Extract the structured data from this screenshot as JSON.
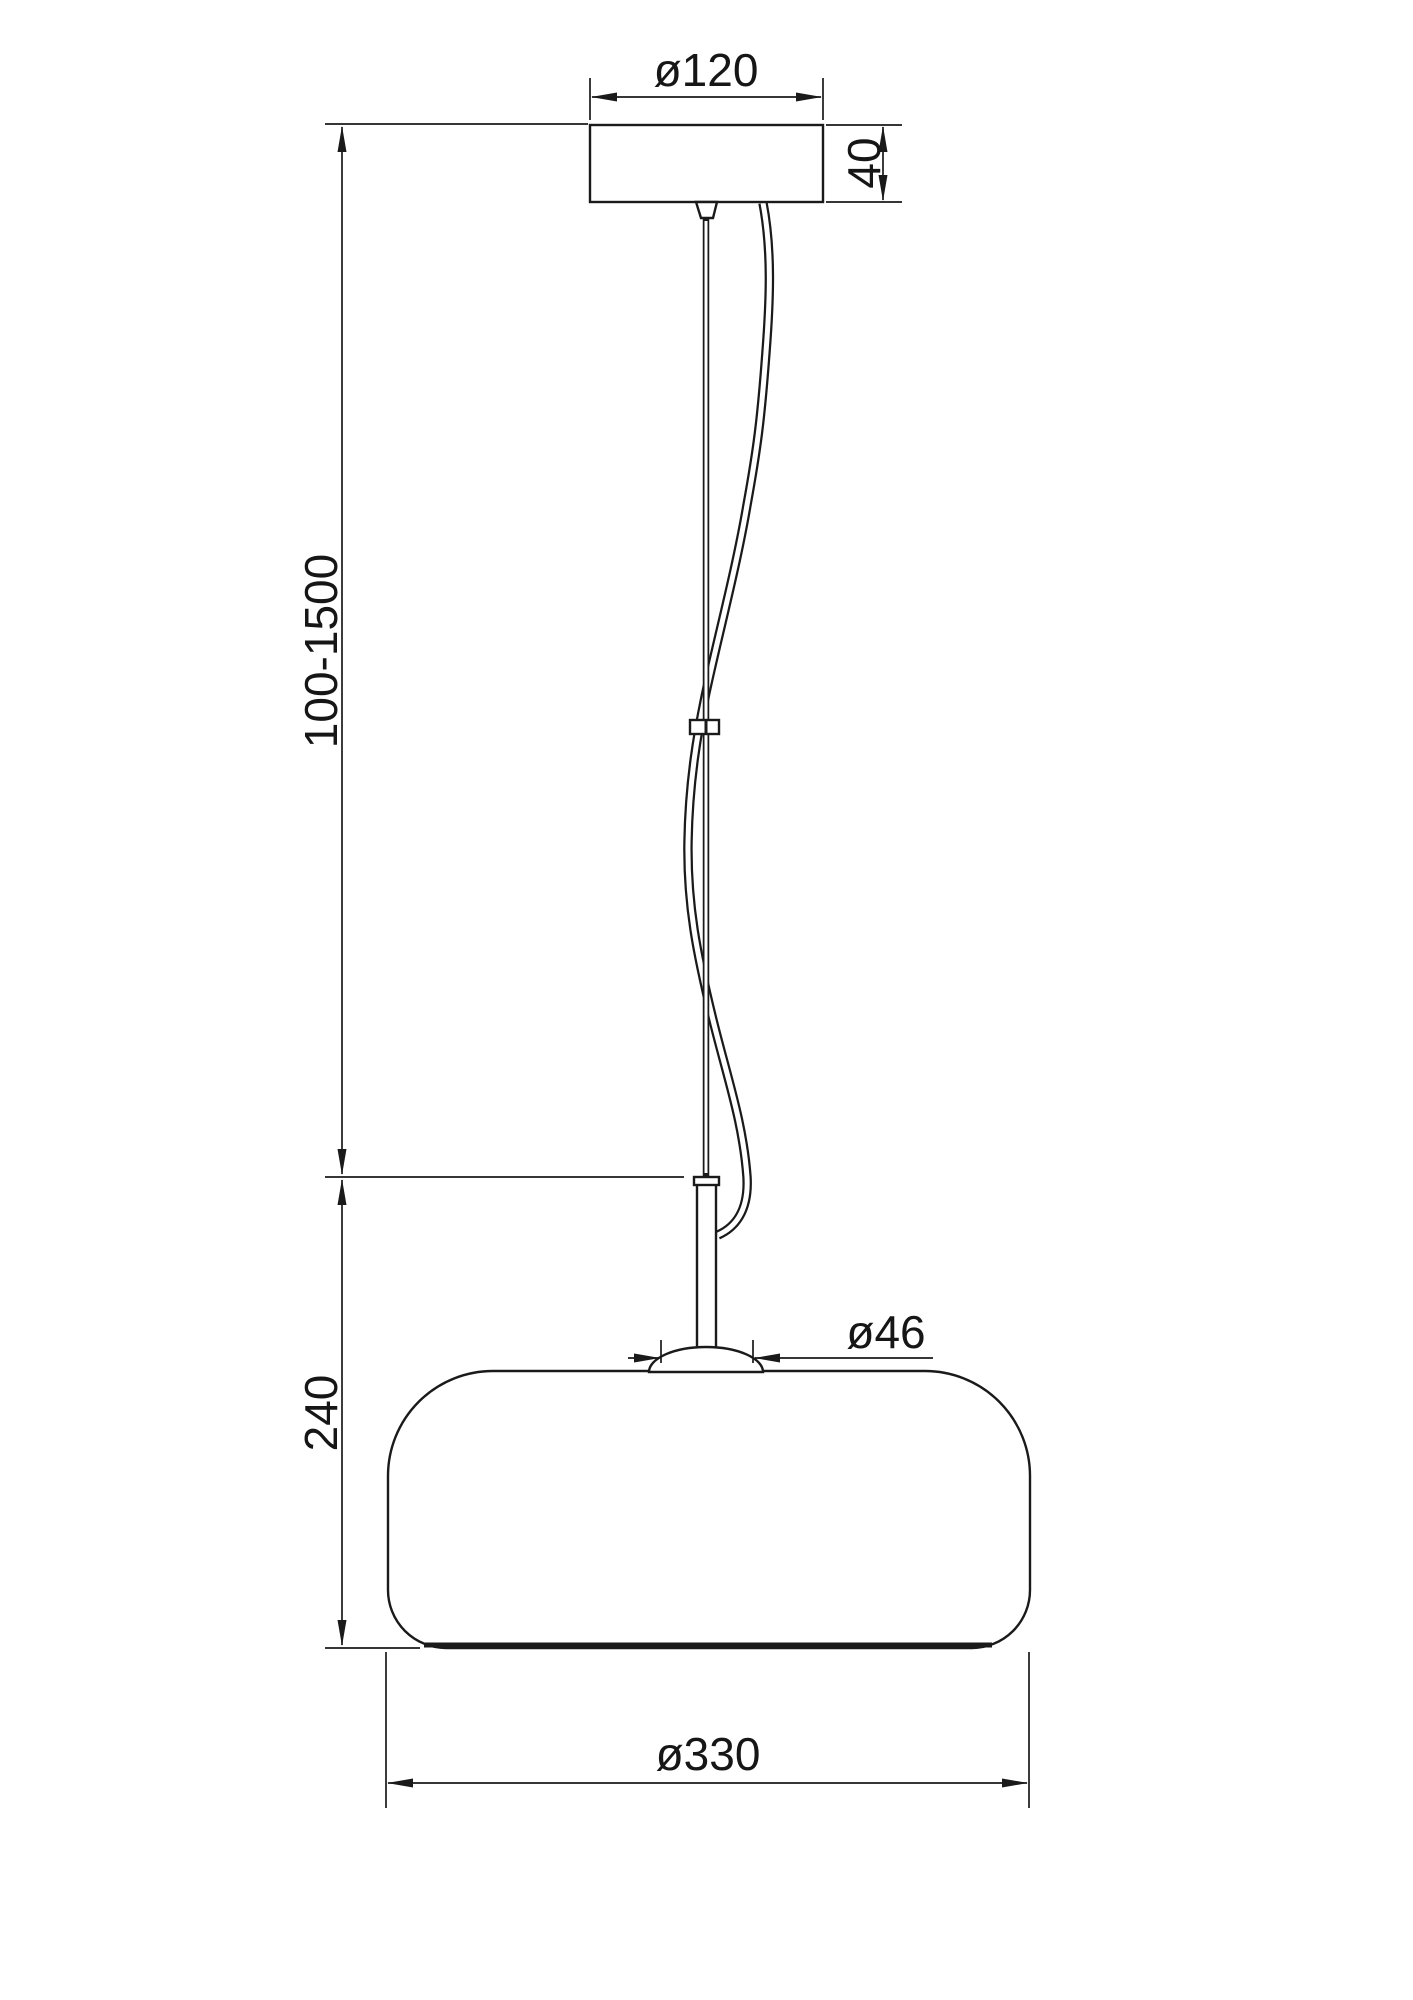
{
  "page": {
    "background": "#ffffff"
  },
  "drawing": {
    "subject": "pendant lamp technical dimension drawing",
    "line_color": "#1a1a1a",
    "labels": {
      "canopy_diameter": "ø120",
      "canopy_height": "40",
      "suspension_length_range": "100-1500",
      "shade_height": "240",
      "fitting_diameter": "ø46",
      "shade_diameter": "ø330"
    }
  }
}
